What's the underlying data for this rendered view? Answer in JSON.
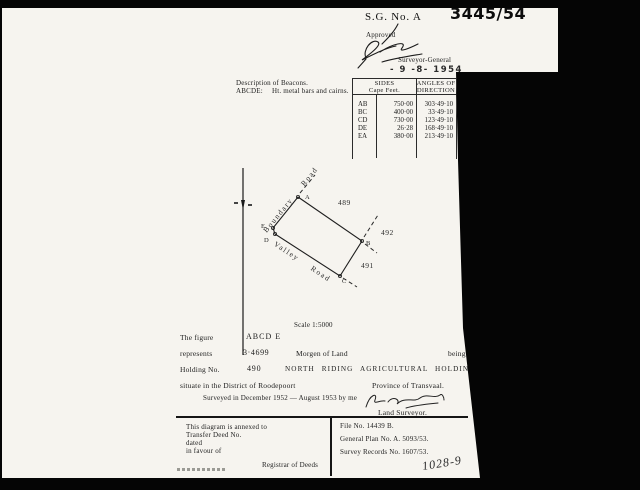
{
  "header": {
    "sg_label": "S.G. No. A",
    "sg_number": "3445/54",
    "approved": "Approved",
    "surveyor_general": "Surveyor-General",
    "approval_date": "- 9 -8- 1954"
  },
  "beacons": {
    "title": "Description of Beacons.",
    "figure_letters": "ABCDE:",
    "description": "Ht. metal bars and cairns."
  },
  "sides_table": {
    "col1_header_line1": "SIDES",
    "col1_header_line2": "Cape Feet.",
    "col2_header_line1": "ANGLES OF",
    "col2_header_line2": "DIRECTION",
    "rows": [
      {
        "side": "AB",
        "length": "750·00",
        "angle": "303·49·10"
      },
      {
        "side": "BC",
        "length": "400·00",
        "angle": "33·49·10"
      },
      {
        "side": "CD",
        "length": "730·00",
        "angle": "123·49·10"
      },
      {
        "side": "DE",
        "length": "26·28",
        "angle": "168·49·10"
      },
      {
        "side": "EA",
        "length": "380·00",
        "angle": "213·49·10"
      }
    ]
  },
  "diagram": {
    "beacons": {
      "a": "A",
      "b": "B",
      "c": "C",
      "d": "D",
      "e": "E"
    },
    "road_upper": "Boundary Road",
    "road_lower": "Valley Road",
    "adjacent_holding_top": "489",
    "adjacent_holding_right": "492",
    "adjacent_holding_bottom": "491",
    "scale": "Scale 1:5000"
  },
  "title_block": {
    "figure_label": "The figure",
    "figure_value": "ABCD E",
    "represents_label": "represents",
    "area_value": "3·4699",
    "area_unit": "Morgen of Land",
    "being": "being",
    "holding_label": "Holding No.",
    "holding_value": "490",
    "holding_name": "NORTH RIDING AGRICULTURAL HOLDINGS",
    "situate": "situate in the District of Roodepoort",
    "province": "Province of Transvaal.",
    "surveyed": "Surveyed in December 1952 — August 1953 by me",
    "land_surveyor": "Land Surveyor."
  },
  "footer": {
    "left_lines": [
      "This diagram is annexed to",
      "Transfer Deed No.",
      "dated",
      "in favour of"
    ],
    "registrar": "Registrar of Deeds",
    "file_no": "File No. 14439 B.",
    "general_plan": "General Plan No. A. 5093/53.",
    "survey_records": "Survey Records No. 1607/53.",
    "handwritten_ref": "1028-9"
  }
}
